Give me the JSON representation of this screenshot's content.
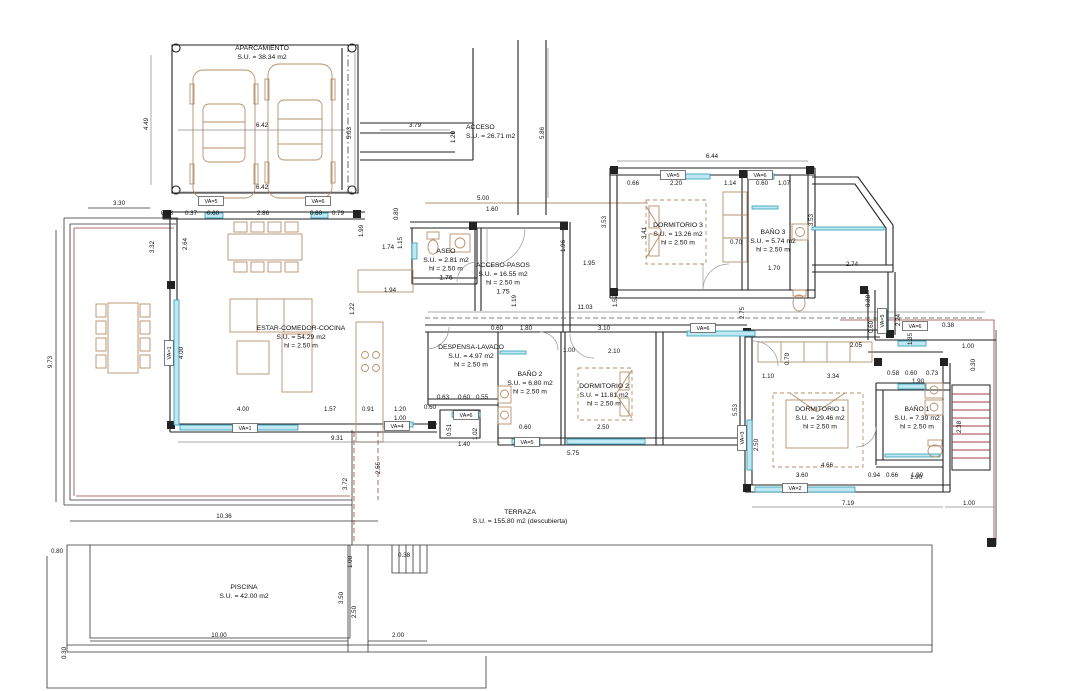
{
  "drawing": {
    "type": "architectural-floor-plan",
    "colors": {
      "wall": "#222222",
      "window_fill": "#bfe8f2",
      "window_stroke": "#2a9db8",
      "furniture": "#b5906a",
      "accent_red": "#a04040",
      "dim_text": "#111111"
    },
    "rooms": [
      {
        "id": "aparcamiento",
        "lines": [
          "APARCAMIENTO",
          "S.U. = 38.34 m2"
        ],
        "x": 262,
        "y": 50,
        "align": "middle"
      },
      {
        "id": "acceso",
        "lines": [
          "ACCESO",
          "S.U. = 26.71 m2"
        ],
        "x": 466,
        "y": 129,
        "align": "start"
      },
      {
        "id": "aseo",
        "lines": [
          "ASEO",
          "S.U. = 2.81 m2",
          "hl = 2.50 m",
          "1.76"
        ],
        "x": 446,
        "y": 253,
        "align": "middle"
      },
      {
        "id": "acceso-pasos",
        "lines": [
          "ACCESO-PASOS",
          "S.U. = 16.55 m2",
          "hl = 2.50 m",
          "1.75"
        ],
        "x": 503,
        "y": 267,
        "align": "middle"
      },
      {
        "id": "estar-comedor-cocina",
        "lines": [
          "ESTAR-COMEDOR-COCINA",
          "S.U. = 54.29 m2",
          "hl = 2.50 m"
        ],
        "x": 301,
        "y": 330,
        "align": "middle"
      },
      {
        "id": "despensa-lavado",
        "lines": [
          "DESPENSA-LAVADO",
          "S.U. = 4.97 m2",
          "hl = 2.50 m"
        ],
        "x": 471,
        "y": 349,
        "align": "middle"
      },
      {
        "id": "bano2",
        "lines": [
          "BAÑO 2",
          "S.U. = 6.80 m2",
          "hl = 2.50 m"
        ],
        "x": 530,
        "y": 376,
        "align": "middle"
      },
      {
        "id": "dormitorio2",
        "lines": [
          "DORMITORIO 2",
          "S.U. = 11.81 m2",
          "hl = 2.50 m"
        ],
        "x": 604,
        "y": 388,
        "align": "middle"
      },
      {
        "id": "dormitorio3",
        "lines": [
          "DORMITORIO 3",
          "S.U. = 13.26 m2",
          "hl = 2.50 m"
        ],
        "x": 678,
        "y": 227,
        "align": "middle"
      },
      {
        "id": "bano3",
        "lines": [
          "BAÑO 3",
          "S.U. = 5.74 m2",
          "hl = 2.50 m"
        ],
        "x": 773,
        "y": 234,
        "align": "middle"
      },
      {
        "id": "dormitorio1",
        "lines": [
          "DORMITORIO 1",
          "S.U. = 29.46 m2",
          "hl = 2.50 m"
        ],
        "x": 820,
        "y": 411,
        "align": "middle"
      },
      {
        "id": "bano1",
        "lines": [
          "BAÑO 1",
          "S.U. = 7.39 m2",
          "hl = 2.50 m"
        ],
        "x": 917,
        "y": 411,
        "align": "middle"
      },
      {
        "id": "terraza",
        "lines": [
          "TERRAZA",
          "S.U. = 155.80 m2 (descubierta)"
        ],
        "x": 520,
        "y": 514,
        "align": "middle"
      },
      {
        "id": "piscina",
        "lines": [
          "PISCINA",
          "S.U. = 42.00 m2"
        ],
        "x": 244,
        "y": 589,
        "align": "middle"
      }
    ],
    "dimensions": [
      {
        "t": "4.49",
        "x": 148,
        "y": 124,
        "v": 1
      },
      {
        "t": "6.42",
        "x": 262,
        "y": 127
      },
      {
        "t": "6.42",
        "x": 262,
        "y": 189
      },
      {
        "t": "5.03",
        "x": 351,
        "y": 133,
        "v": 1
      },
      {
        "t": "3.79",
        "x": 415,
        "y": 127
      },
      {
        "t": "1.20",
        "x": 455,
        "y": 137,
        "v": 1
      },
      {
        "t": "5.86",
        "x": 544,
        "y": 133,
        "v": 1
      },
      {
        "t": "3.30",
        "x": 119,
        "y": 205
      },
      {
        "t": "5.00",
        "x": 483,
        "y": 200
      },
      {
        "t": "1.60",
        "x": 492,
        "y": 211
      },
      {
        "t": "0.80",
        "x": 398,
        "y": 214,
        "v": 1
      },
      {
        "t": "0.38",
        "x": 167,
        "y": 215
      },
      {
        "t": "0.37",
        "x": 191,
        "y": 215
      },
      {
        "t": "0.60",
        "x": 213,
        "y": 215
      },
      {
        "t": "2.86",
        "x": 263,
        "y": 215
      },
      {
        "t": "0.60",
        "x": 316,
        "y": 215
      },
      {
        "t": "0.79",
        "x": 338,
        "y": 215
      },
      {
        "t": "2.64",
        "x": 187,
        "y": 244,
        "v": 1
      },
      {
        "t": "3.32",
        "x": 154,
        "y": 247,
        "v": 1
      },
      {
        "t": "9.73",
        "x": 52,
        "y": 362,
        "v": 1
      },
      {
        "t": "1.99",
        "x": 363,
        "y": 231,
        "v": 1
      },
      {
        "t": "1.15",
        "x": 402,
        "y": 243,
        "v": 1
      },
      {
        "t": "1.74",
        "x": 388,
        "y": 249
      },
      {
        "t": "1.94",
        "x": 390,
        "y": 292
      },
      {
        "t": "1.22",
        "x": 354,
        "y": 309,
        "v": 1
      },
      {
        "t": "4.00",
        "x": 183,
        "y": 353,
        "v": 1
      },
      {
        "t": "4.00",
        "x": 243,
        "y": 411
      },
      {
        "t": "1.57",
        "x": 330,
        "y": 411
      },
      {
        "t": "0.91",
        "x": 368,
        "y": 411
      },
      {
        "t": "1.20",
        "x": 400,
        "y": 411
      },
      {
        "t": "1.00",
        "x": 400,
        "y": 420
      },
      {
        "t": "9.31",
        "x": 337,
        "y": 440
      },
      {
        "t": "0.51",
        "x": 451,
        "y": 430,
        "v": 1
      },
      {
        "t": "1.02",
        "x": 477,
        "y": 434,
        "v": 1
      },
      {
        "t": "1.40",
        "x": 464,
        "y": 446
      },
      {
        "t": "1.96",
        "x": 565,
        "y": 246,
        "v": 1
      },
      {
        "t": "1.95",
        "x": 589,
        "y": 265
      },
      {
        "t": "11.03",
        "x": 585,
        "y": 309
      },
      {
        "t": "1.19",
        "x": 516,
        "y": 301,
        "v": 1
      },
      {
        "t": "1.52",
        "x": 617,
        "y": 301,
        "v": 1
      },
      {
        "t": "6.44",
        "x": 712,
        "y": 158
      },
      {
        "t": "0.66",
        "x": 633,
        "y": 185
      },
      {
        "t": "2.20",
        "x": 676,
        "y": 185
      },
      {
        "t": "1.14",
        "x": 730,
        "y": 185
      },
      {
        "t": "0.60",
        "x": 762,
        "y": 185
      },
      {
        "t": "1.07",
        "x": 784,
        "y": 185
      },
      {
        "t": "3.53",
        "x": 606,
        "y": 222,
        "v": 1
      },
      {
        "t": "3.41",
        "x": 646,
        "y": 233,
        "v": 1
      },
      {
        "t": "0.70",
        "x": 736,
        "y": 244
      },
      {
        "t": "1.70",
        "x": 774,
        "y": 270
      },
      {
        "t": "3.53",
        "x": 813,
        "y": 220,
        "v": 1
      },
      {
        "t": "2.74",
        "x": 852,
        "y": 266
      },
      {
        "t": "0.88",
        "x": 870,
        "y": 301,
        "v": 1
      },
      {
        "t": "0.60",
        "x": 873,
        "y": 327,
        "v": 1
      },
      {
        "t": "2.24",
        "x": 900,
        "y": 320,
        "v": 1
      },
      {
        "t": "1.35",
        "x": 912,
        "y": 339,
        "v": 1
      },
      {
        "t": "0.38",
        "x": 948,
        "y": 327
      },
      {
        "t": "2.05",
        "x": 856,
        "y": 347
      },
      {
        "t": "1.00",
        "x": 968,
        "y": 348
      },
      {
        "t": "0.30",
        "x": 975,
        "y": 365,
        "v": 1
      },
      {
        "t": "2.75",
        "x": 744,
        "y": 313,
        "v": 1
      },
      {
        "t": "0.60",
        "x": 497,
        "y": 330
      },
      {
        "t": "1.80",
        "x": 526,
        "y": 330
      },
      {
        "t": "3.10",
        "x": 604,
        "y": 330
      },
      {
        "t": "1.00",
        "x": 569,
        "y": 352
      },
      {
        "t": "2.10",
        "x": 614,
        "y": 353
      },
      {
        "t": "0.63",
        "x": 443,
        "y": 399
      },
      {
        "t": "0.60",
        "x": 464,
        "y": 399
      },
      {
        "t": "0.55",
        "x": 482,
        "y": 399
      },
      {
        "t": "0.60",
        "x": 430,
        "y": 409
      },
      {
        "t": "0.60",
        "x": 525,
        "y": 429
      },
      {
        "t": "2.50",
        "x": 603,
        "y": 429
      },
      {
        "t": "5.75",
        "x": 573,
        "y": 455
      },
      {
        "t": "5.53",
        "x": 737,
        "y": 410,
        "v": 1
      },
      {
        "t": "0.70",
        "x": 789,
        "y": 359,
        "v": 1
      },
      {
        "t": "1.10",
        "x": 768,
        "y": 378
      },
      {
        "t": "3.34",
        "x": 833,
        "y": 378
      },
      {
        "t": "2.50",
        "x": 758,
        "y": 445,
        "v": 1
      },
      {
        "t": "4.66",
        "x": 827,
        "y": 467
      },
      {
        "t": "3.60",
        "x": 802,
        "y": 477
      },
      {
        "t": "0.94",
        "x": 874,
        "y": 477
      },
      {
        "t": "0.66",
        "x": 892,
        "y": 477
      },
      {
        "t": "1.90",
        "x": 917,
        "y": 477
      },
      {
        "t": "7.19",
        "x": 848,
        "y": 505
      },
      {
        "t": "1.00",
        "x": 969,
        "y": 505
      },
      {
        "t": "0.58",
        "x": 893,
        "y": 375
      },
      {
        "t": "0.60",
        "x": 911,
        "y": 375
      },
      {
        "t": "0.73",
        "x": 932,
        "y": 375
      },
      {
        "t": "1.90",
        "x": 918,
        "y": 383
      },
      {
        "t": "1.90",
        "x": 916,
        "y": 479
      },
      {
        "t": "2.38",
        "x": 961,
        "y": 427,
        "v": 1
      },
      {
        "t": "10.36",
        "x": 224,
        "y": 518
      },
      {
        "t": "3.72",
        "x": 347,
        "y": 484,
        "v": 1
      },
      {
        "t": "2.55",
        "x": 380,
        "y": 468,
        "v": 1
      },
      {
        "t": "0.80",
        "x": 57,
        "y": 553
      },
      {
        "t": "10.00",
        "x": 219,
        "y": 637
      },
      {
        "t": "2.00",
        "x": 398,
        "y": 637
      },
      {
        "t": "1.00",
        "x": 352,
        "y": 562,
        "v": 1
      },
      {
        "t": "3.50",
        "x": 343,
        "y": 598,
        "v": 1
      },
      {
        "t": "2.50",
        "x": 356,
        "y": 612,
        "v": 1
      },
      {
        "t": "0.38",
        "x": 404,
        "y": 557
      },
      {
        "t": "0.30",
        "x": 66,
        "y": 653,
        "v": 1
      }
    ],
    "window_tags": [
      {
        "t": "VA=5",
        "x": 211,
        "y": 203
      },
      {
        "t": "VA=6",
        "x": 318,
        "y": 203
      },
      {
        "t": "VA=1",
        "x": 171,
        "y": 353,
        "v": 1
      },
      {
        "t": "VA=1",
        "x": 245,
        "y": 430
      },
      {
        "t": "VA=4",
        "x": 397,
        "y": 428
      },
      {
        "t": "VA=6",
        "x": 466,
        "y": 417
      },
      {
        "t": "VA=5",
        "x": 527,
        "y": 444
      },
      {
        "t": "VA=5",
        "x": 673,
        "y": 177
      },
      {
        "t": "VA=6",
        "x": 760,
        "y": 177
      },
      {
        "t": "VA=6",
        "x": 703,
        "y": 330
      },
      {
        "t": "VA=6",
        "x": 915,
        "y": 328
      },
      {
        "t": "VA=5",
        "x": 884,
        "y": 321,
        "v": 1
      },
      {
        "t": "VA=3",
        "x": 744,
        "y": 438,
        "v": 1
      },
      {
        "t": "VA=2",
        "x": 795,
        "y": 490
      }
    ]
  }
}
